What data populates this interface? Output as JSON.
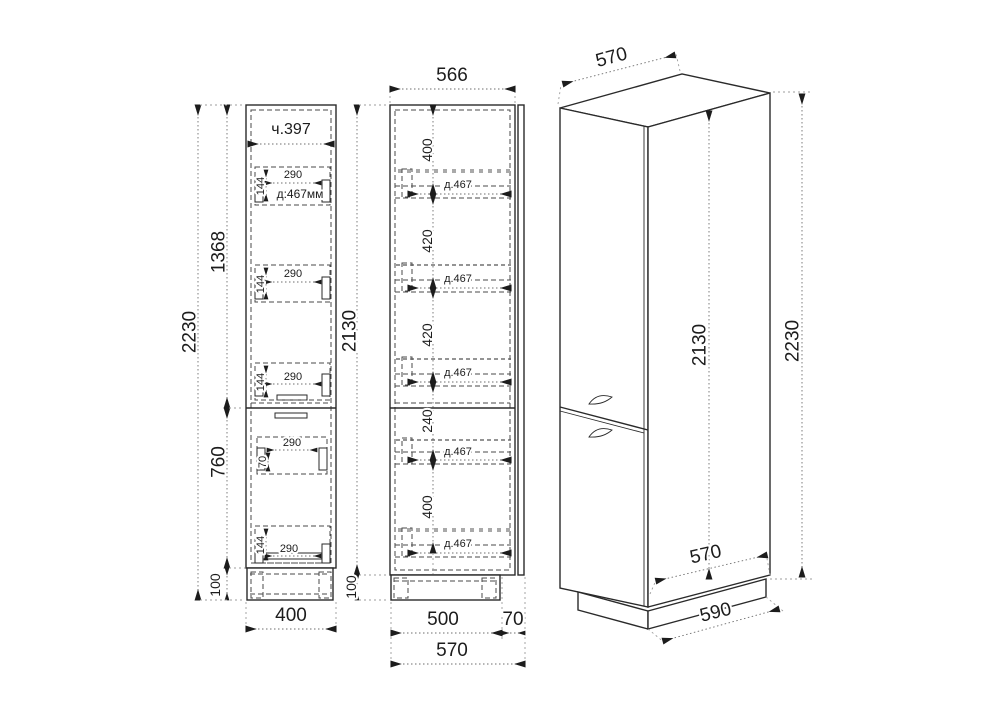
{
  "front_view": {
    "width_top_label": "ч.397",
    "height_total": "2230",
    "height_upper": "1368",
    "height_lower": "760",
    "height_plinth": "100",
    "width_bottom": "400",
    "handle_boxes": [
      {
        "width": "290",
        "height": "144",
        "extra": "д:467мм"
      },
      {
        "width": "290",
        "height": "144",
        "extra": ""
      },
      {
        "width": "290",
        "height": "144",
        "extra": ""
      },
      {
        "width": "290",
        "height": "70",
        "extra": ""
      },
      {
        "width": "290",
        "height": "144",
        "extra": ""
      }
    ]
  },
  "side_view": {
    "depth_top": "566",
    "height_body": "2130",
    "height_plinth": "100",
    "chain": [
      "400",
      "420",
      "420",
      "240",
      "400"
    ],
    "shelves": [
      "д.467",
      "д.467",
      "д.467",
      "д.467",
      "д.467"
    ],
    "depth_body": "500",
    "depth_door": "70",
    "depth_total": "570"
  },
  "iso_view": {
    "width_top": "570",
    "height_body": "2130",
    "height_total": "2230",
    "depth_bottom": "570",
    "depth_base": "590"
  }
}
